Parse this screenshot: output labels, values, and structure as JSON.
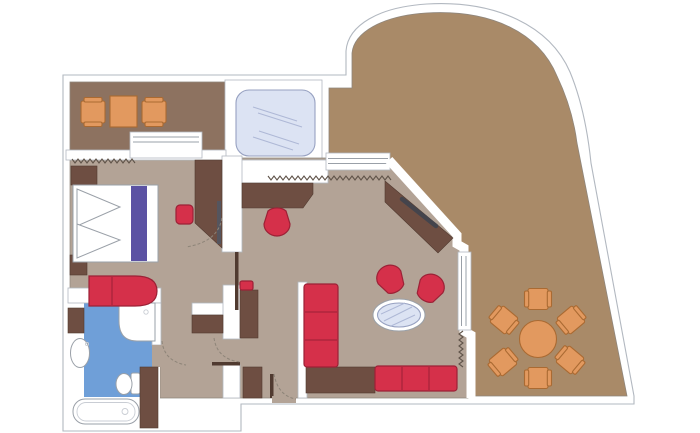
{
  "meta": {
    "type": "floor-plan",
    "description": "Suite floor plan with bedroom, bathroom, dressing hall, living room, whirlpool deck, front balcony and large curved wrap-around terrace"
  },
  "palette": {
    "wall-white": "#ffffff",
    "wall-line": "#b2b8c0",
    "area-edge": "#8f867c",
    "terrace": "#a98a68",
    "balcony": "#8d7260",
    "floor": "#b3a396",
    "wood-dark": "#6e4e42",
    "wood-edge": "#503a30",
    "red": "#d5304a",
    "red-dark": "#9c2136",
    "purple": "#5b52a3",
    "orange": "#e2995f",
    "orange-dark": "#aa6a32",
    "bath-blue": "#6f9fd8",
    "glass": "#dce3f3",
    "glass-edge": "#97a1c1",
    "glass-line": "#aeb8d6",
    "fixture-edge": "#9aa0a8",
    "fixture-inner": "#c9cdd4",
    "curtain": "#5f5349",
    "door-arc": "#8d8478",
    "gray-edge": "#55555e",
    "tv": "#44444c"
  },
  "rooms": [
    {
      "name": "front-balcony",
      "furniture": [
        "armchair",
        "side-table",
        "armchair"
      ]
    },
    {
      "name": "whirlpool-deck",
      "furniture": [
        "whirlpool-bath"
      ]
    },
    {
      "name": "bedroom",
      "furniture": [
        "double-bed",
        "two-pillows",
        "bed-runner",
        "nightstand",
        "nightstand",
        "love-seat",
        "ottoman",
        "wardrobe"
      ]
    },
    {
      "name": "bathroom",
      "furniture": [
        "vanity-cabinet",
        "washbasin",
        "shower",
        "toilet",
        "bathtub"
      ]
    },
    {
      "name": "dressing-hall",
      "furniture": [
        "desk",
        "desk-chair",
        "closet",
        "closet",
        "closet",
        "sliding-door",
        "stool"
      ]
    },
    {
      "name": "living-room",
      "furniture": [
        "tv-sideboard",
        "tub-chair",
        "tub-chair",
        "oval-glass-table",
        "corner-sofa",
        "corner-table"
      ]
    },
    {
      "name": "terrace",
      "furniture": [
        "round-dining-table",
        "dining-chair",
        "dining-chair",
        "dining-chair",
        "dining-chair",
        "dining-chair",
        "dining-chair"
      ]
    }
  ]
}
